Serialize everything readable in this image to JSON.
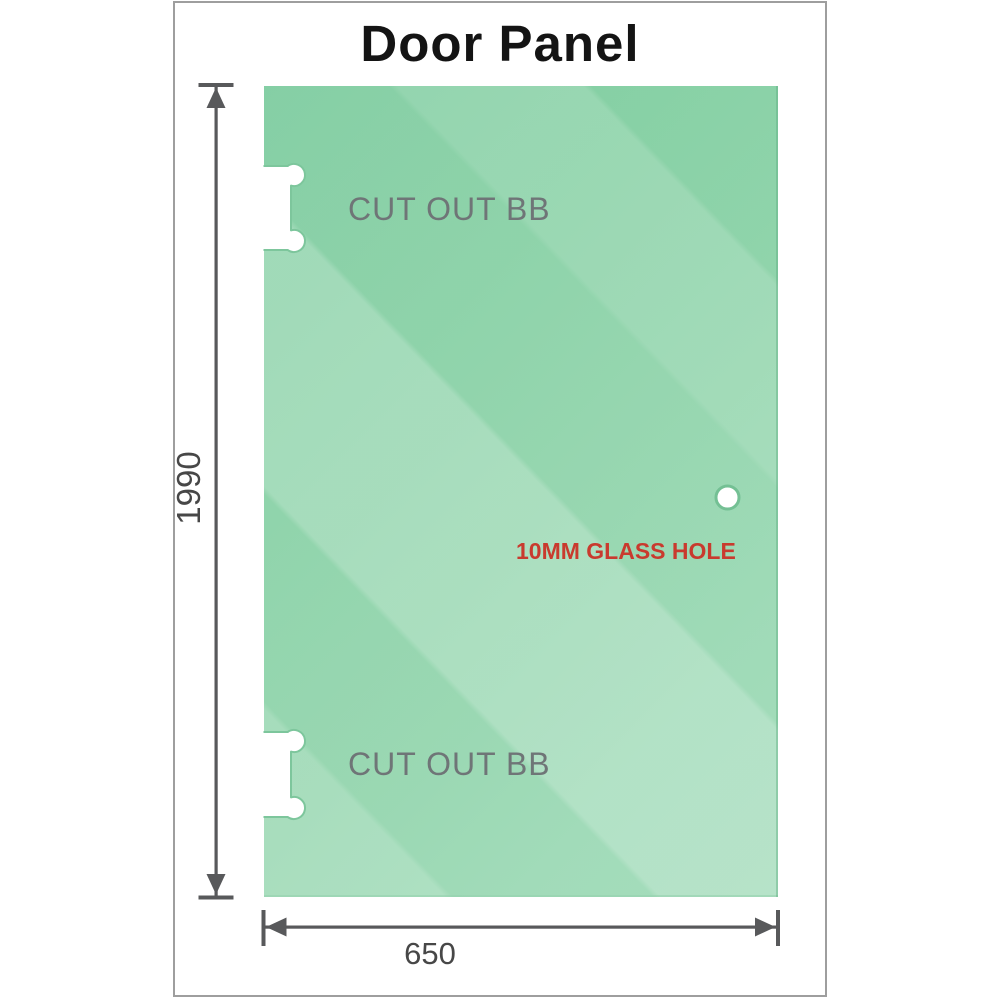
{
  "title": "Door Panel",
  "panel": {
    "material": "glass",
    "cutouts": [
      {
        "label": "CUT OUT BB",
        "position": "top-left-edge"
      },
      {
        "label": "CUT OUT BB",
        "position": "bottom-left-edge"
      }
    ],
    "hole": {
      "label": "10MM GLASS HOLE"
    }
  },
  "dimensions": {
    "height": {
      "value": "1990"
    },
    "width": {
      "value": "650"
    }
  },
  "colors": {
    "glass_base": "#86d0a4",
    "glass_dark_corner": "#7ccb9e",
    "glass_light_band": "#b4e2c8",
    "cutout_fill": "#ffffff",
    "cutout_rim": "#7dc69c",
    "hole_rim": "#74c094",
    "dimension_line": "#58595b",
    "dimension_text": "#474747",
    "cutout_text": "#6f7577",
    "hole_text": "#c93a2e",
    "title_text": "#141414",
    "frame_border": "#9e9e9e"
  }
}
